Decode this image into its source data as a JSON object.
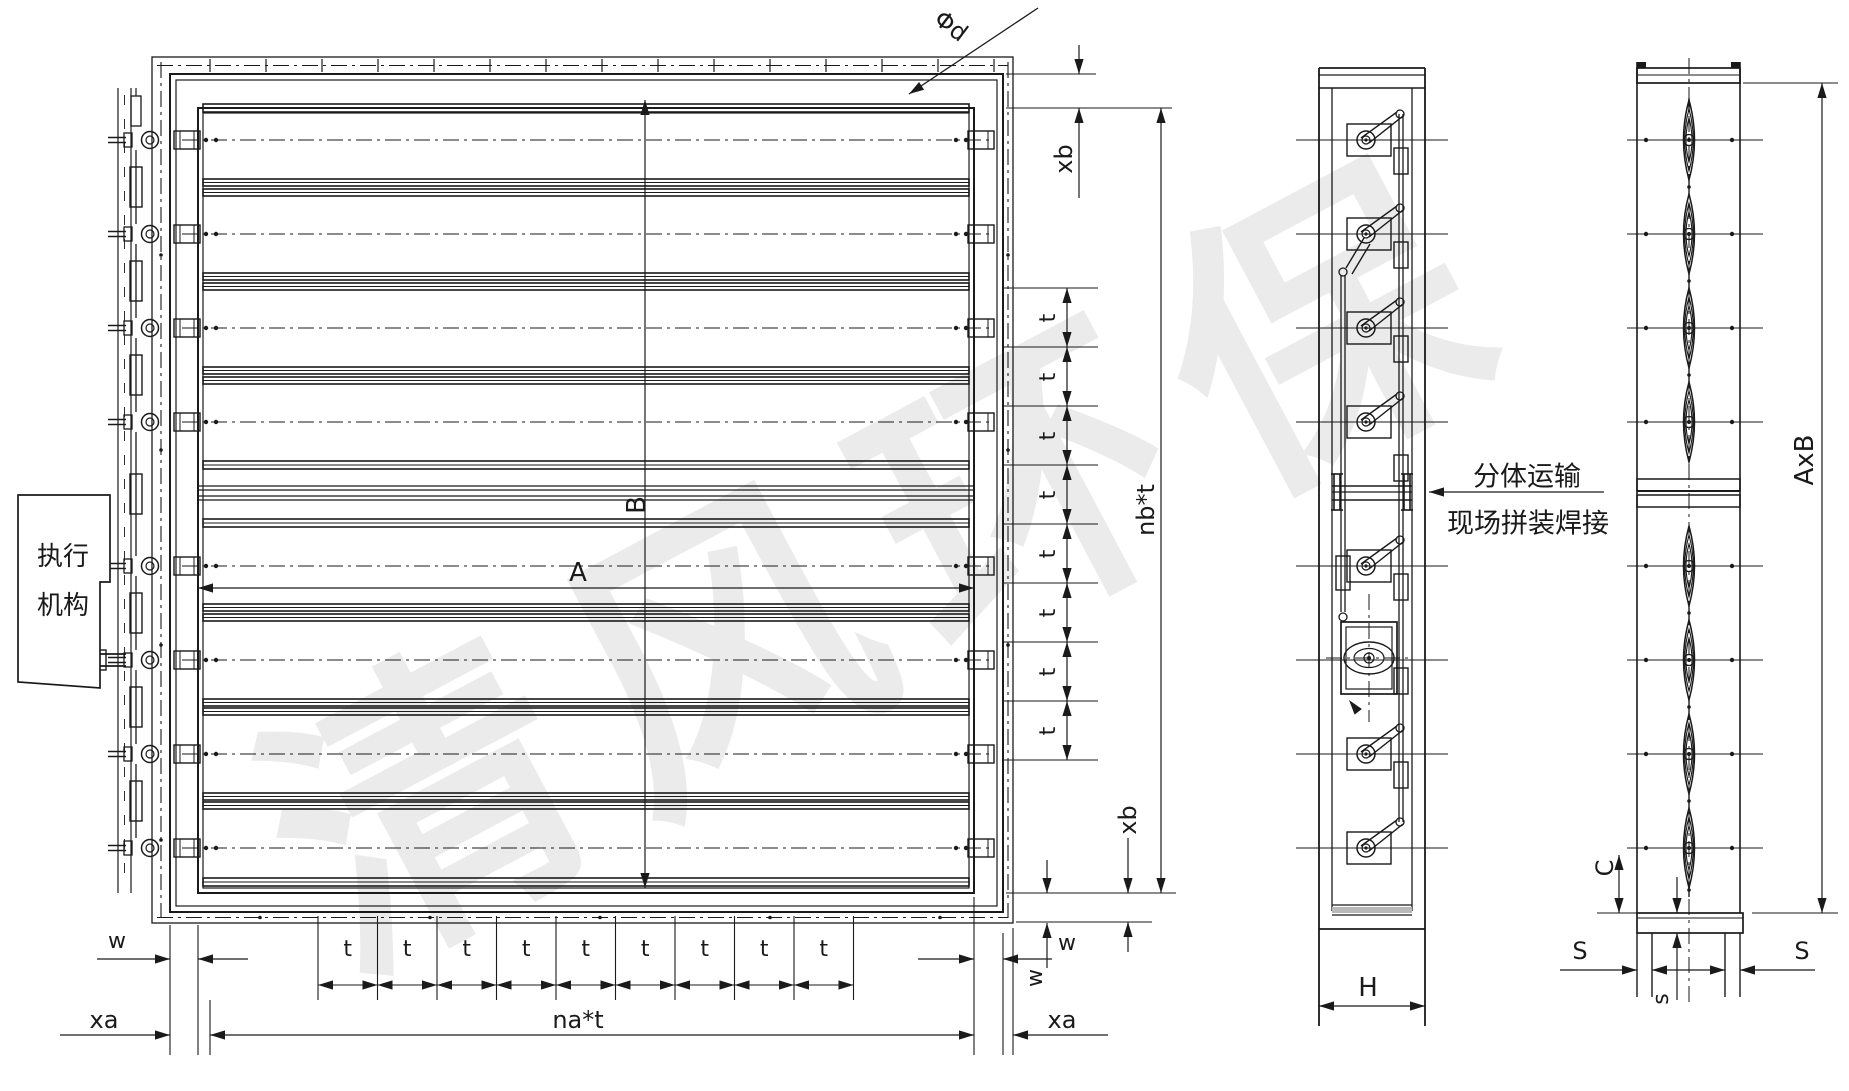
{
  "watermark": "清风环保",
  "labels": {
    "phi_d": "Φd",
    "xb": "xb",
    "t": "t",
    "nb_t": "nb*t",
    "na_t": "na*t",
    "w": "w",
    "xa": "xa",
    "A": "A",
    "B": "B",
    "H": "H",
    "AxB": "AxB",
    "C": "C",
    "S": "S",
    "s": "s"
  },
  "actuator_box": {
    "line1": "执行",
    "line2": "机构"
  },
  "site_note": {
    "line1": "分体运输",
    "line2": "现场拼装焊接"
  }
}
